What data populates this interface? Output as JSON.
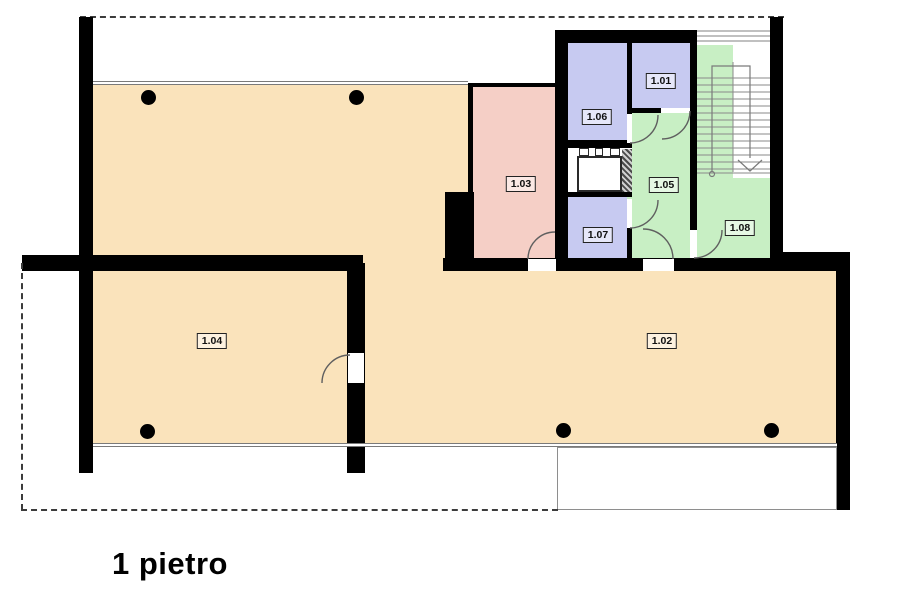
{
  "title": "1 pietro",
  "rooms": {
    "r101": {
      "label": "1.01",
      "color": "#c7caf1"
    },
    "r102": {
      "label": "1.02",
      "color": "#fae3bb"
    },
    "r103": {
      "label": "1.03",
      "color": "#f5cfc6"
    },
    "r104": {
      "label": "1.04",
      "color": "#fae3bb"
    },
    "r105": {
      "label": "1.05",
      "color": "#c8efc4"
    },
    "r106": {
      "label": "1.06",
      "color": "#c7caf1"
    },
    "r107": {
      "label": "1.07",
      "color": "#c7caf1"
    },
    "r108": {
      "label": "1.08",
      "color": "#c8efc4"
    }
  },
  "colors": {
    "wall": "#000000",
    "window_line": "#7a7a7a",
    "door_arc": "#5f5f5f",
    "stair_line": "#8a8a8a",
    "dashed_outline": "#3c3c3c",
    "column": "#000000",
    "elevator_shaft": "#ffffff"
  }
}
